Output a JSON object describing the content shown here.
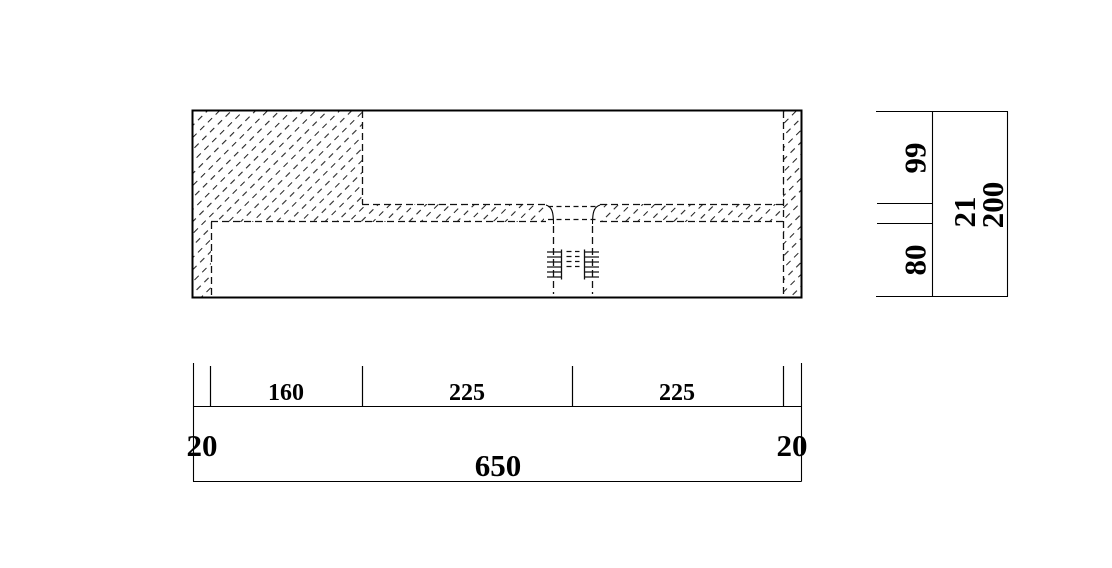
{
  "drawing": {
    "kind": "section-drawing-with-dimensions",
    "colors": {
      "line": "#000000",
      "background": "#ffffff"
    }
  },
  "dims": {
    "bottom": {
      "end_left": "20",
      "seg_160": "160",
      "seg_225_a": "225",
      "seg_225_b": "225",
      "end_right": "20",
      "total": "650"
    },
    "right": {
      "top": "99",
      "mid": "21",
      "bottom": "80",
      "total": "200"
    }
  }
}
